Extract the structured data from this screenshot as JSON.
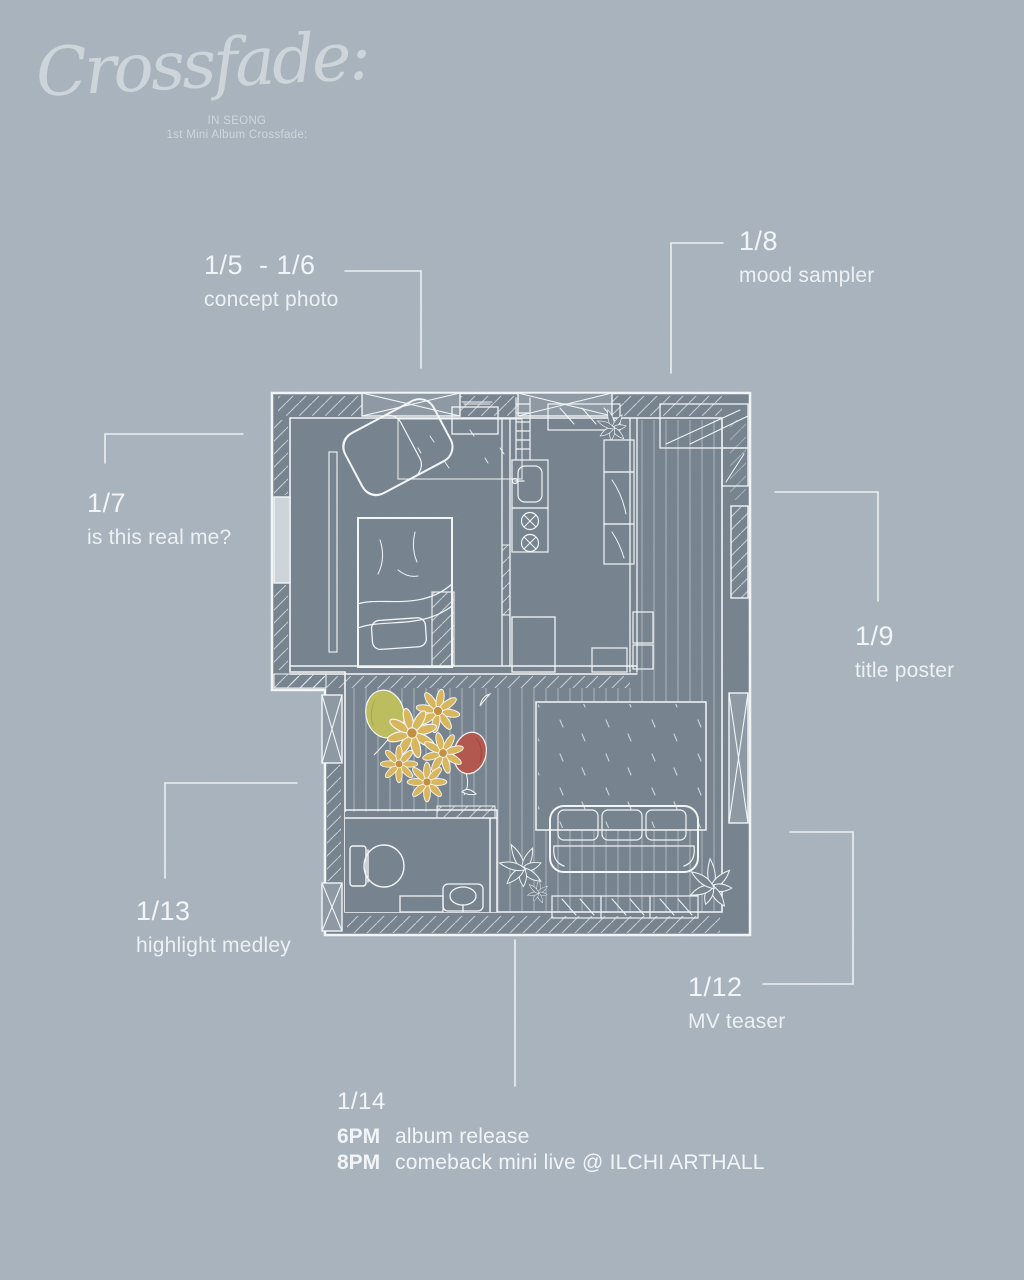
{
  "logo": {
    "title": "Crossfade:",
    "artist": "IN SEONG",
    "album": "1st Mini Album Crossfade:"
  },
  "callouts": [
    {
      "id": "concept-photo",
      "date": "1/5  - 1/6",
      "label": "concept photo"
    },
    {
      "id": "mood-sampler",
      "date": "1/8",
      "label": "mood sampler"
    },
    {
      "id": "is-this-real-me",
      "date": "1/7",
      "label": "is this real me?"
    },
    {
      "id": "title-poster",
      "date": "1/9",
      "label": "title poster"
    },
    {
      "id": "highlight-medley",
      "date": "1/13",
      "label": "highlight medley"
    },
    {
      "id": "mv-teaser",
      "date": "1/12",
      "label": "MV teaser"
    }
  ],
  "finale": {
    "date": "1/14",
    "events": [
      {
        "time": "6PM",
        "label": "album release"
      },
      {
        "time": "8PM",
        "label": "comeback mini live @ ILCHI ARTHALL"
      }
    ]
  },
  "floorplan": {
    "rooms": [
      "bedroom",
      "kitchen",
      "hallway",
      "living room",
      "bathroom"
    ],
    "objects": [
      "bed",
      "pillow",
      "armchair",
      "rug",
      "dresser",
      "ladder",
      "kitchen-sink",
      "stove",
      "cabinets",
      "wardrobe",
      "sofa",
      "shoe-rack",
      "toilet",
      "bath-sink",
      "plants",
      "flower-bouquet",
      "balloons"
    ]
  },
  "colors": {
    "background": "#a9b3bd",
    "floor": "#76838e",
    "line": "#f2f5f6",
    "balloon_yellow": "#bcbd5e",
    "balloon_red": "#b3574d",
    "flower_petal": "#d9b65c",
    "flower_center": "#c3903f"
  }
}
